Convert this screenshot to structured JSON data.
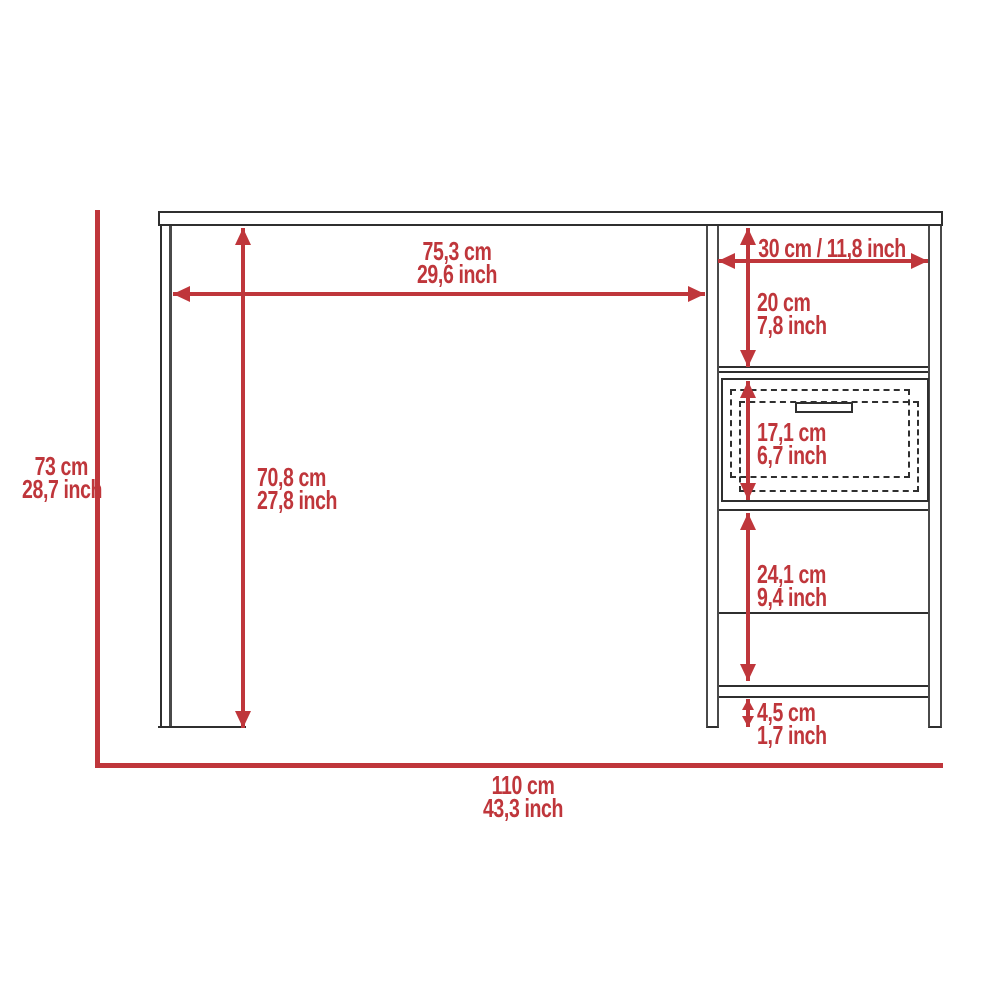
{
  "labels": {
    "overall_width": {
      "cm": "110 cm",
      "inch": "43,3 inch"
    },
    "overall_height": {
      "cm": "73 cm",
      "inch": "28,7 inch"
    },
    "desktop_width": {
      "cm": "75,3 cm",
      "inch": "29,6 inch"
    },
    "underdesk_height": {
      "cm": "70,8 cm",
      "inch": "27,8 inch"
    },
    "side_unit_width": {
      "text": "30 cm / 11,8 inch"
    },
    "top_compartment_height": {
      "cm": "20 cm",
      "inch": "7,8 inch"
    },
    "drawer_height": {
      "cm": "17,1 cm",
      "inch": "6,7 inch"
    },
    "lower_compartment_height": {
      "cm": "24,1 cm",
      "inch": "9,4 inch"
    },
    "base_clearance_height": {
      "cm": "4,5 cm",
      "inch": "1,7 inch"
    }
  },
  "colors": {
    "dimension_red": "#BF363B",
    "outline_dark": "#2F2F2F",
    "outline_gray": "#4A4A4A",
    "background": "#FFFFFF"
  }
}
